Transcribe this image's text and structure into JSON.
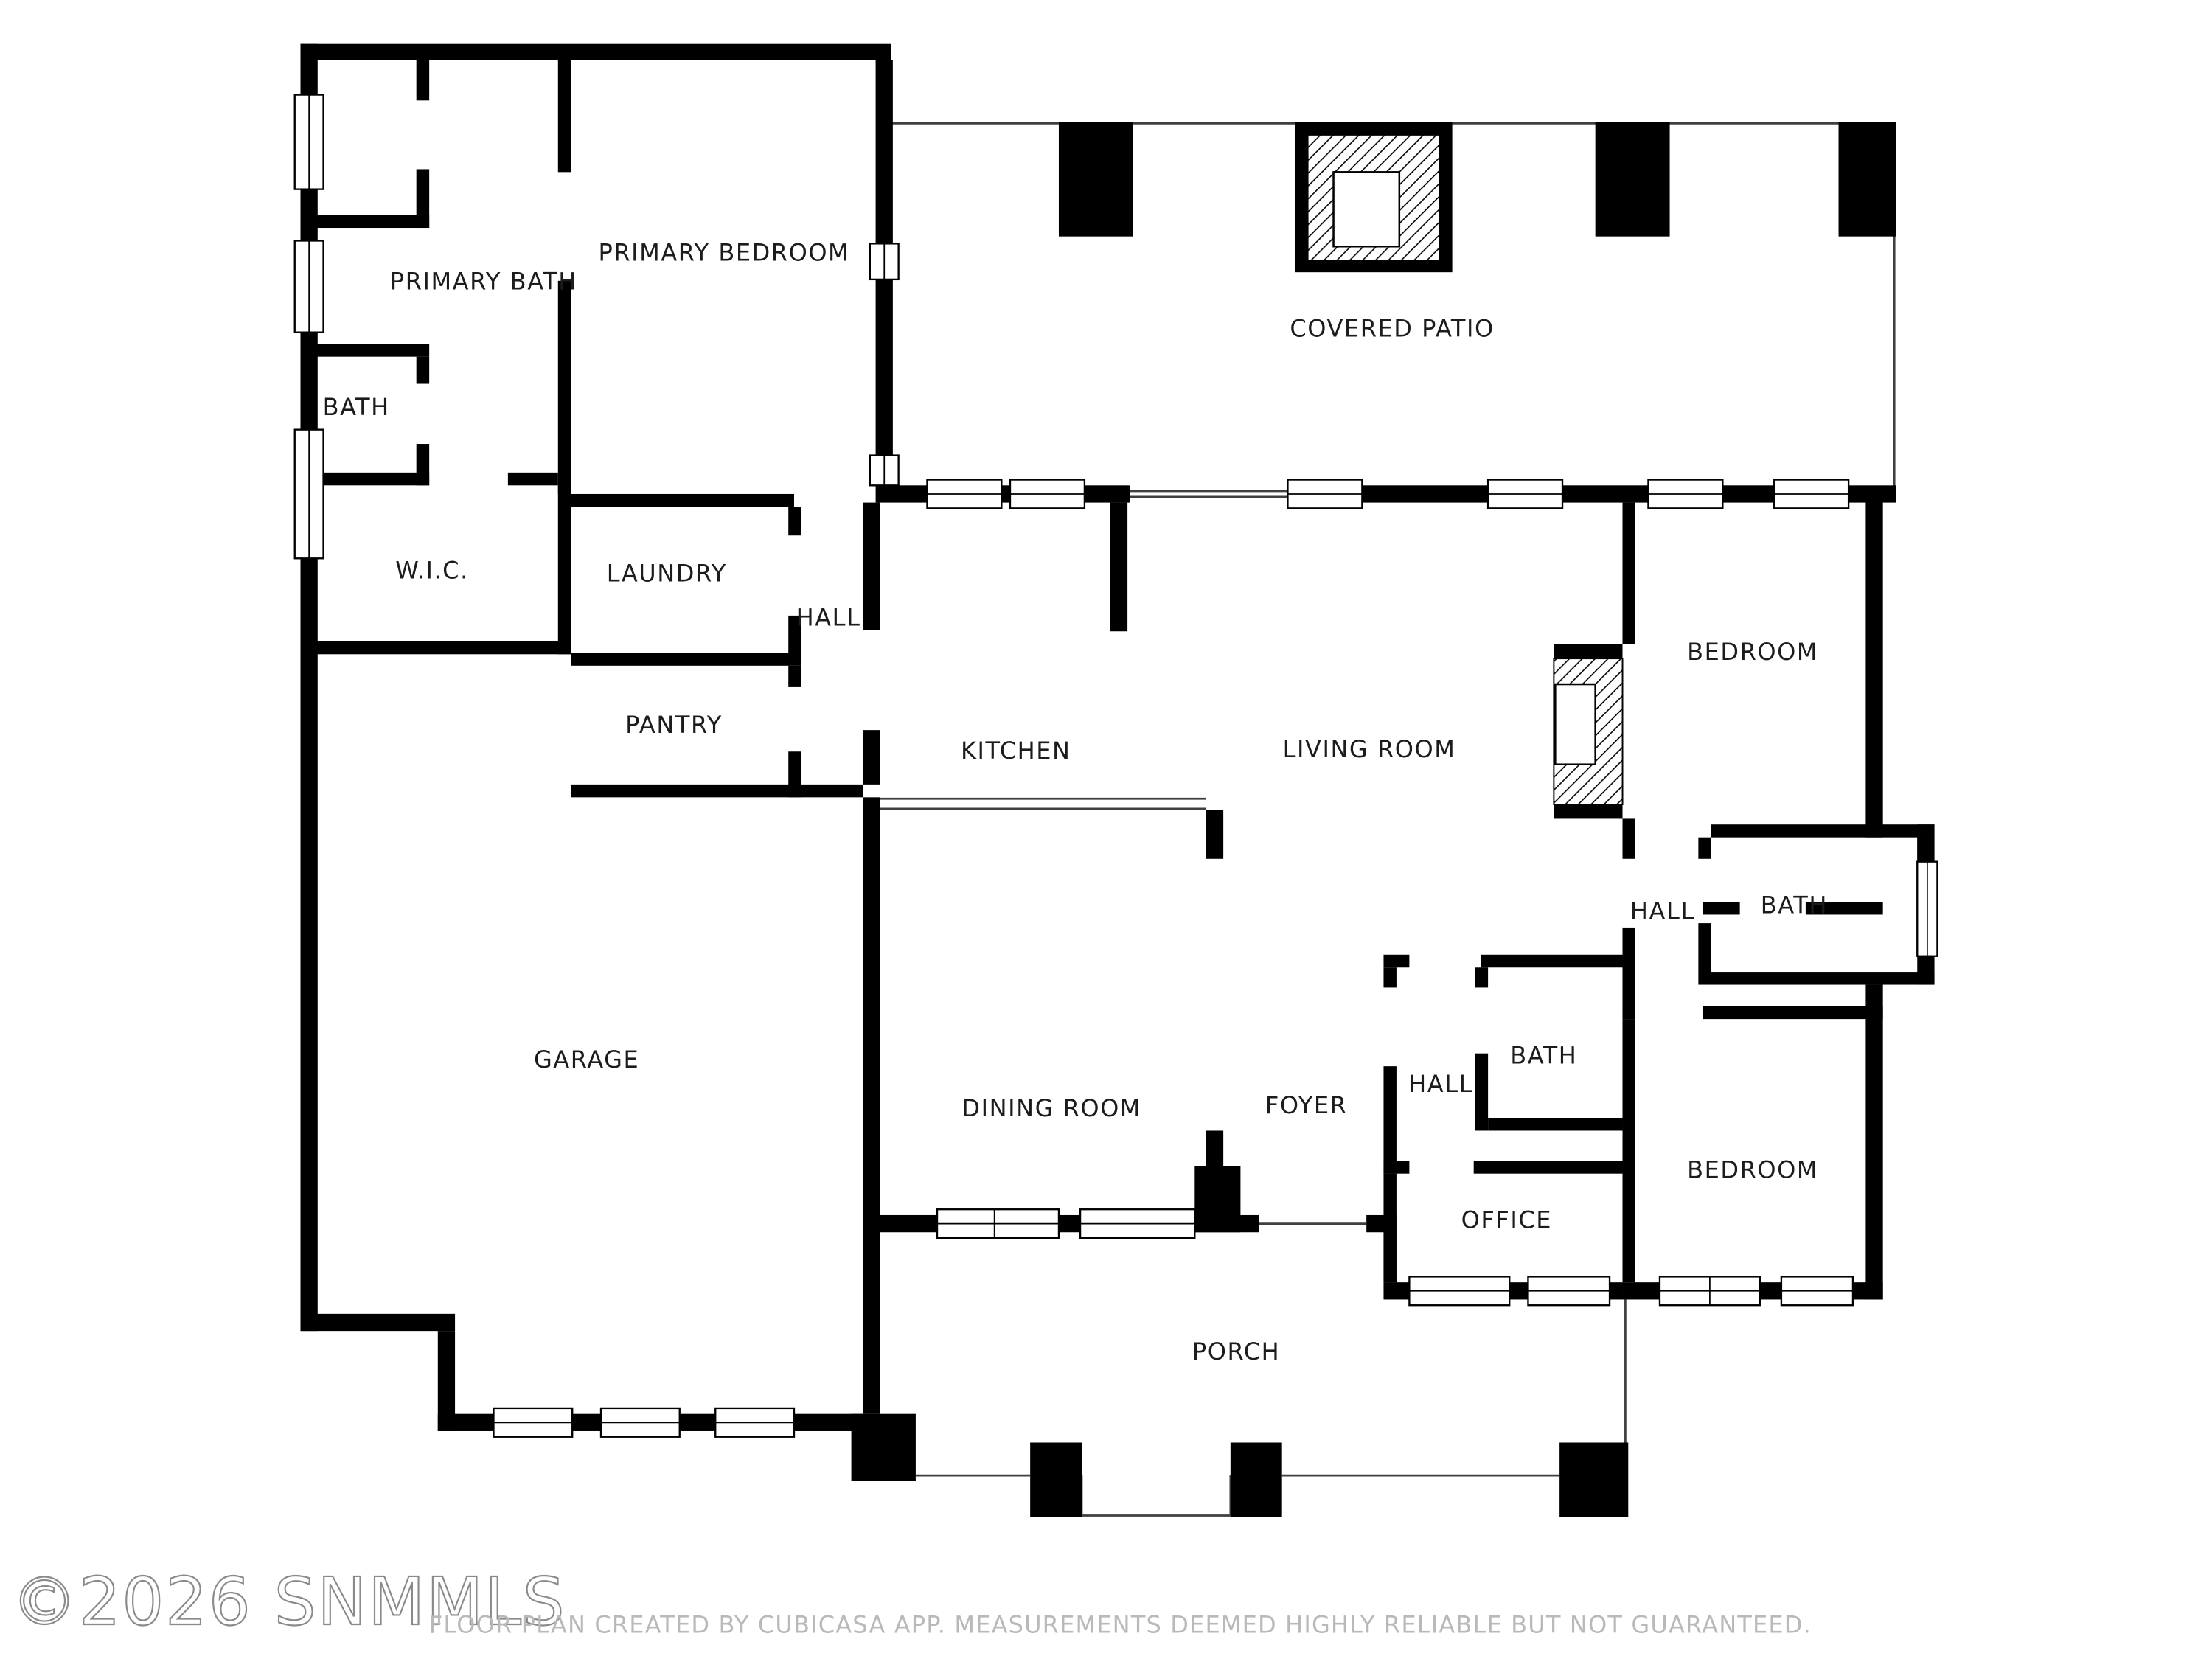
{
  "plan": {
    "type": "residential-floor-plan",
    "wall_color": "#000000",
    "line_color": "#3f3f3f",
    "label_color": "#1c1c1c",
    "background": "#ffffff"
  },
  "rooms": [
    {
      "id": "primary-bath",
      "label": "PRIMARY BATH"
    },
    {
      "id": "primary-bedroom",
      "label": "PRIMARY BEDROOM"
    },
    {
      "id": "bath-primary-suite",
      "label": "BATH"
    },
    {
      "id": "wic",
      "label": "W.I.C."
    },
    {
      "id": "laundry",
      "label": "LAUNDRY"
    },
    {
      "id": "hall-left",
      "label": "HALL"
    },
    {
      "id": "pantry",
      "label": "PANTRY"
    },
    {
      "id": "covered-patio",
      "label": "COVERED PATIO"
    },
    {
      "id": "kitchen",
      "label": "KITCHEN"
    },
    {
      "id": "living-room",
      "label": "LIVING ROOM"
    },
    {
      "id": "bedroom-right",
      "label": "BEDROOM"
    },
    {
      "id": "hall-right",
      "label": "HALL"
    },
    {
      "id": "bath-right",
      "label": "BATH"
    },
    {
      "id": "garage",
      "label": "GARAGE"
    },
    {
      "id": "dining-room",
      "label": "DINING ROOM"
    },
    {
      "id": "foyer",
      "label": "FOYER"
    },
    {
      "id": "hall-center",
      "label": "HALL"
    },
    {
      "id": "bath-center",
      "label": "BATH"
    },
    {
      "id": "office",
      "label": "OFFICE"
    },
    {
      "id": "bedroom-bottom",
      "label": "BEDROOM"
    },
    {
      "id": "porch",
      "label": "PORCH"
    }
  ],
  "features": {
    "patio_fireplace": "fireplace-hatched",
    "living_room_fireplace": "fireplace-hatched",
    "patio_pillars": 3,
    "porch_pillars": 3
  },
  "footer": {
    "copyright": "©2026 SNMMLS",
    "disclaimer": "FLOOR PLAN CREATED BY CUBICASA APP. MEASUREMENTS DEEMED HIGHLY RELIABLE BUT NOT GUARANTEED."
  }
}
